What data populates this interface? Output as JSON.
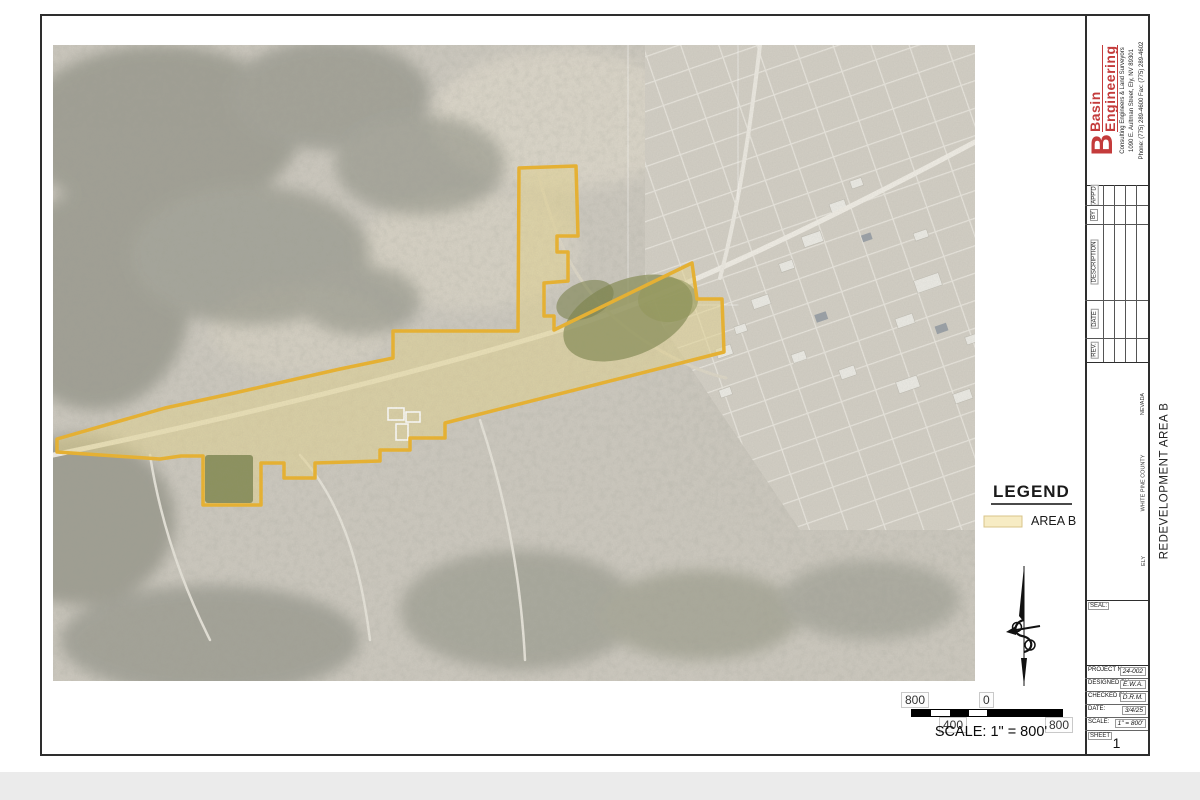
{
  "sheet": {
    "firm": {
      "monogram": "B",
      "name_top": "Basin",
      "name_bottom": "Engineering",
      "tagline": "Consulting Engineers & Land Surveyors",
      "address": "1090 E. Aultman Street, Ely, NV 89301",
      "phone_fax": "Phone: (775) 289-4600   Fax: (775) 289-4602",
      "brand_color": "#c43b3b"
    },
    "revision_table": {
      "headers": [
        "REV.",
        "DATE",
        "DESCRIPTION",
        "BY",
        "APP'D"
      ],
      "empty_rows": 4
    },
    "title_block": {
      "line1": "REDEVELOPMENT AREA B",
      "line2": "CITY OF ELY",
      "line3": "CITY OF ELY PLANNING DEPARTMENT",
      "city": "ELY",
      "county": "WHITE PINE COUNTY",
      "state": "NEVADA"
    },
    "seal_label": "SEAL:",
    "project_info": {
      "rows": [
        {
          "label": "PROJECT No.:",
          "value": "24-002"
        },
        {
          "label": "DESIGNED BY:",
          "value": "E.W.A."
        },
        {
          "label": "CHECKED BY:",
          "value": "D.R.M."
        },
        {
          "label": "DATE:",
          "value": "3/4/25"
        },
        {
          "label": "SCALE:",
          "value": "1\" = 800'"
        }
      ],
      "sheet_label": "SHEET",
      "sheet_number": "1"
    }
  },
  "map": {
    "legend": {
      "title": "LEGEND",
      "area_b_label": "AREA B",
      "swatch_fill": "#f7ecc4",
      "swatch_stroke": "#d9c48a"
    },
    "area_b": {
      "fill": "#e6d690",
      "fill_opacity": "0.55",
      "stroke": "#ecb32c"
    },
    "north_arrow": "ornamental-compass-needle",
    "scale_bar": {
      "top_left": "800",
      "top_mid": "0",
      "bottom_mid": "400",
      "bottom_right": "800",
      "caption": "SCALE: 1\" = 800'"
    }
  }
}
